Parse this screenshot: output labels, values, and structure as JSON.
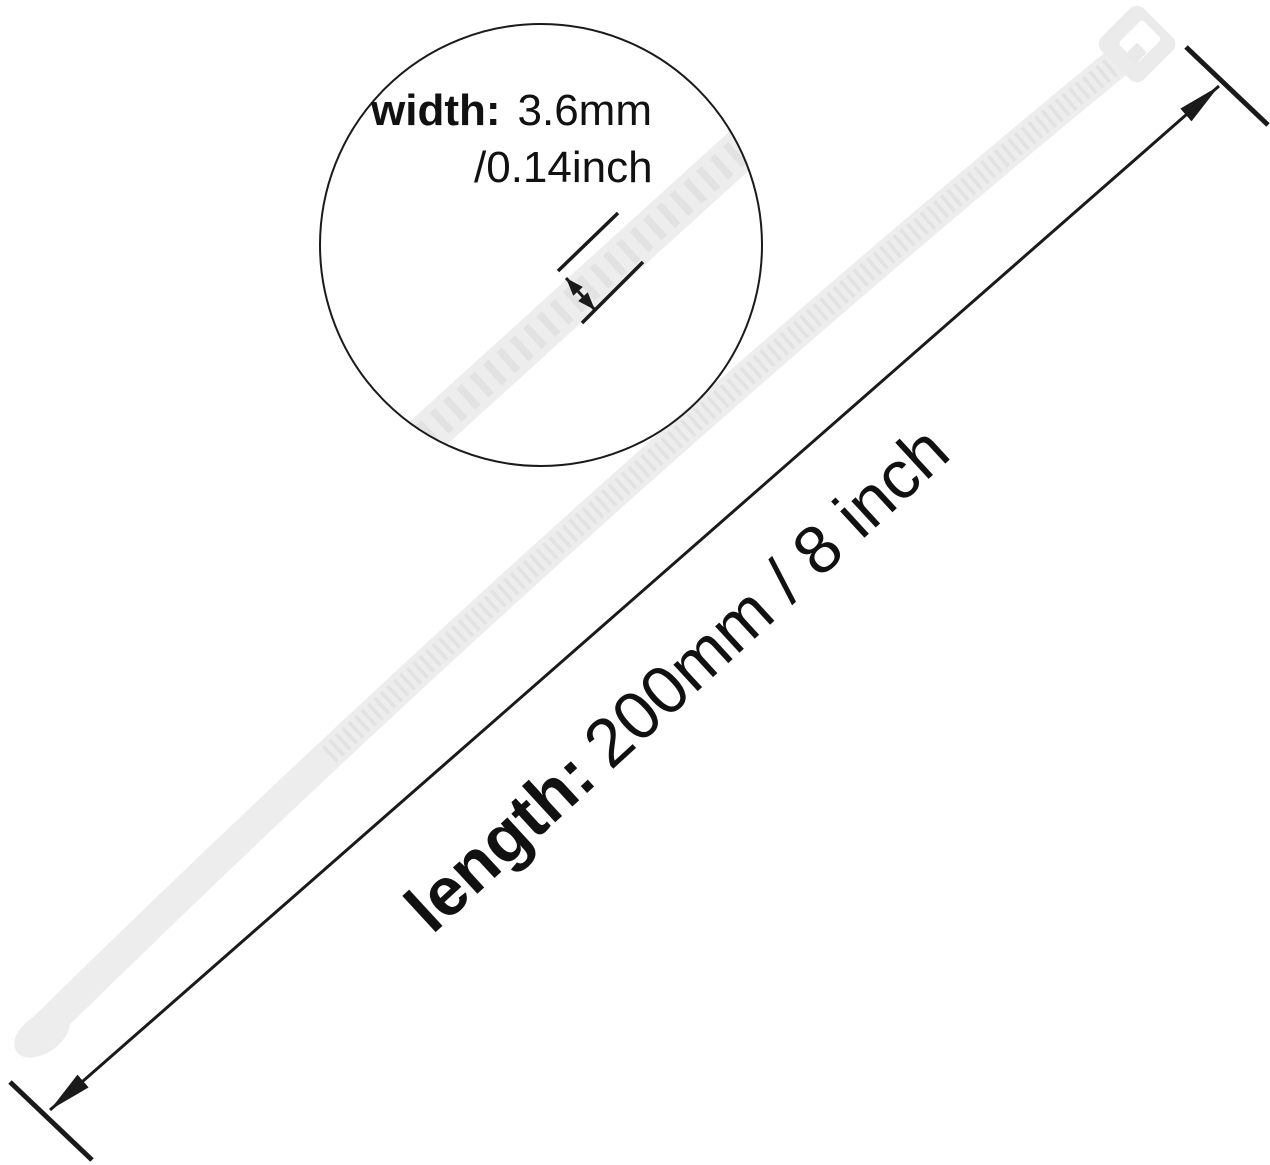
{
  "figure": {
    "subject": "white nylon cable zip tie with dimension annotations"
  },
  "magnifier": {
    "width_label": "width:",
    "width_mm": "3.6mm",
    "width_inch": "/0.14inch"
  },
  "length": {
    "label": "length:",
    "value": "200mm / 8 inch"
  },
  "colors": {
    "background": "#ffffff",
    "tie_body": "#ededed",
    "tie_teeth": "#e2e2e2",
    "head": "#ebebeb",
    "pawl": "#e9e9e9",
    "annotation_line": "#1a1a1a",
    "text": "#111111"
  }
}
